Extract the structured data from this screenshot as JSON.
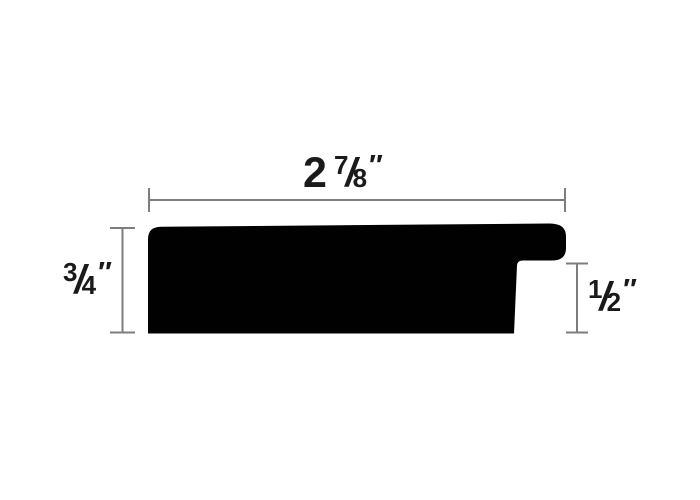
{
  "diagram": {
    "type": "picture-frame-moulding-profile-cross-section",
    "background": "#ffffff",
    "colors": {
      "shape": "#010101",
      "dimension_line": "#7d7d7d",
      "text": "#1a1a1a"
    },
    "dimensions": {
      "width": {
        "label": "2 7/8″",
        "whole": "2",
        "numerator": "7",
        "slash": "/",
        "denominator": "8",
        "unit": "″"
      },
      "height": {
        "label": "3/4″",
        "numerator": "3",
        "slash": "/",
        "denominator": "4",
        "unit": "″"
      },
      "rabbet": {
        "label": "1/2″",
        "numerator": "1",
        "slash": "/",
        "denominator": "2",
        "unit": "″"
      }
    }
  }
}
